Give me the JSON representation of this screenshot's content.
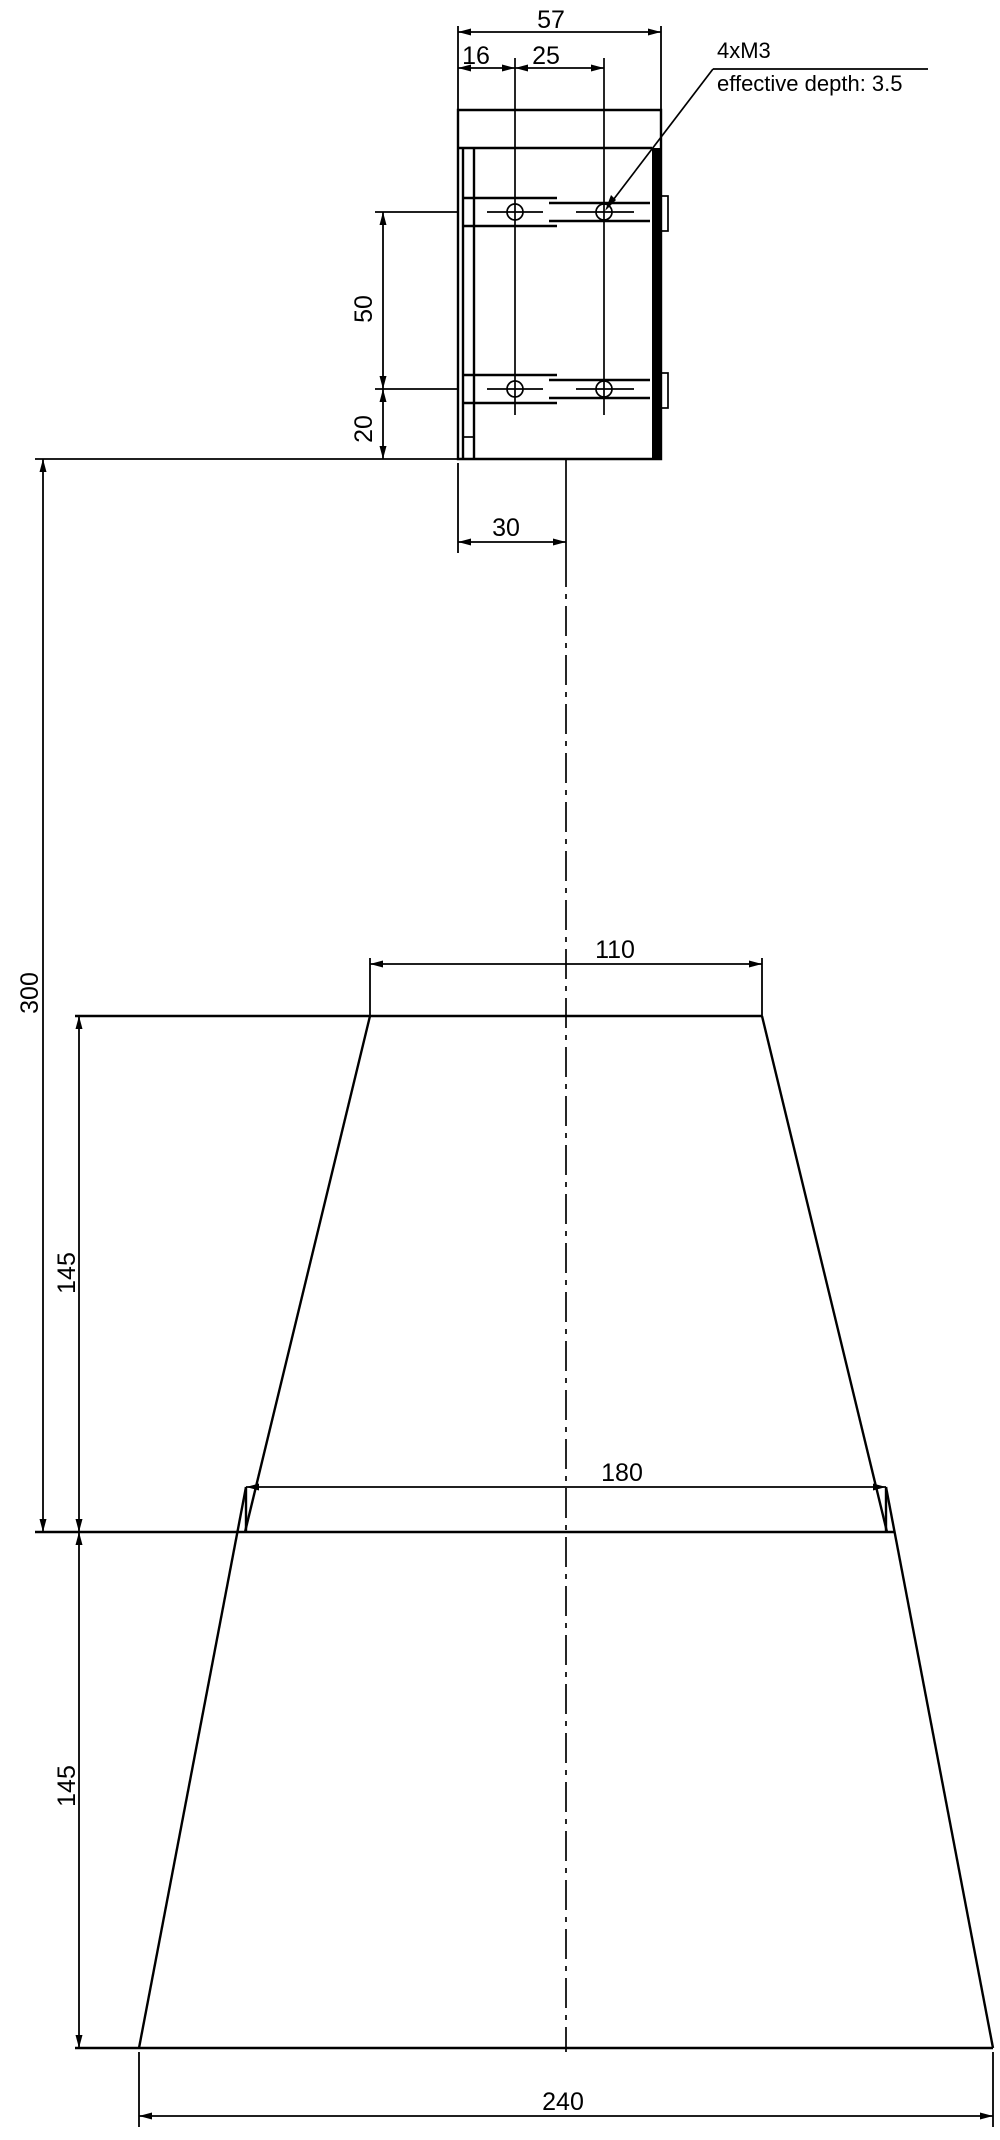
{
  "callout": {
    "line1": "4xM3",
    "line2": "effective depth: 3.5"
  },
  "dims": {
    "bracket_width": "57",
    "hole_offset": "16",
    "hole_spacing": "25",
    "hole_row_spacing": "50",
    "bottom_hole_offset": "20",
    "center_offset": "30",
    "overall_height": "300",
    "upper_section_height": "145",
    "lower_section_height": "145",
    "top_width": "110",
    "middle_width": "180",
    "bottom_width": "240"
  },
  "colors": {
    "line": "#000000",
    "background": "#ffffff"
  }
}
